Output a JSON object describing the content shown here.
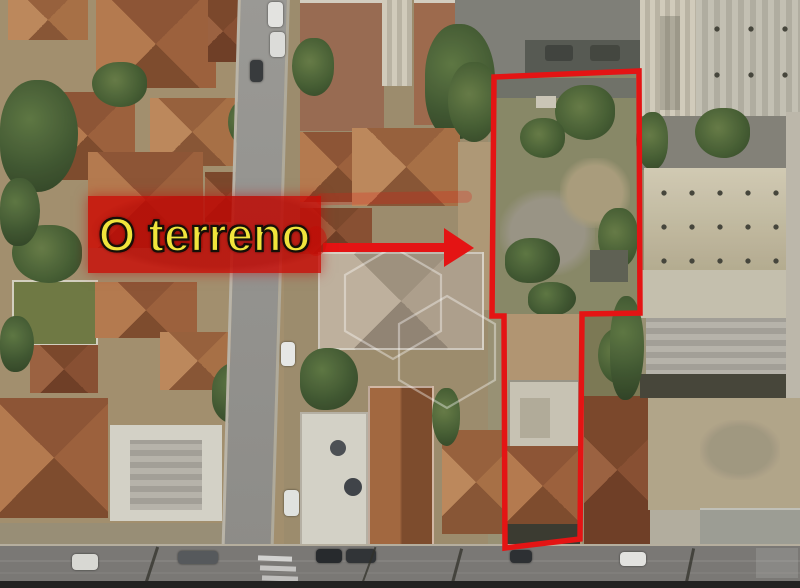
{
  "annotation": {
    "label": "O terreno",
    "label_text_color": "#f0e43c",
    "label_box_color": "rgba(201,12,6,0.82)",
    "outline_color": "#e41414",
    "arrow_color": "#e41414",
    "lot_outline_points": "494,77 639,71 640,313 582,314 580,539 505,548 504,316 492,316",
    "arrow_points": "323,243 444,243 444,228 474,248 444,267 444,252 323,252"
  },
  "watermark": {
    "icon": "cube-wireframe-icon",
    "color": "rgba(255,255,255,0.38)"
  }
}
